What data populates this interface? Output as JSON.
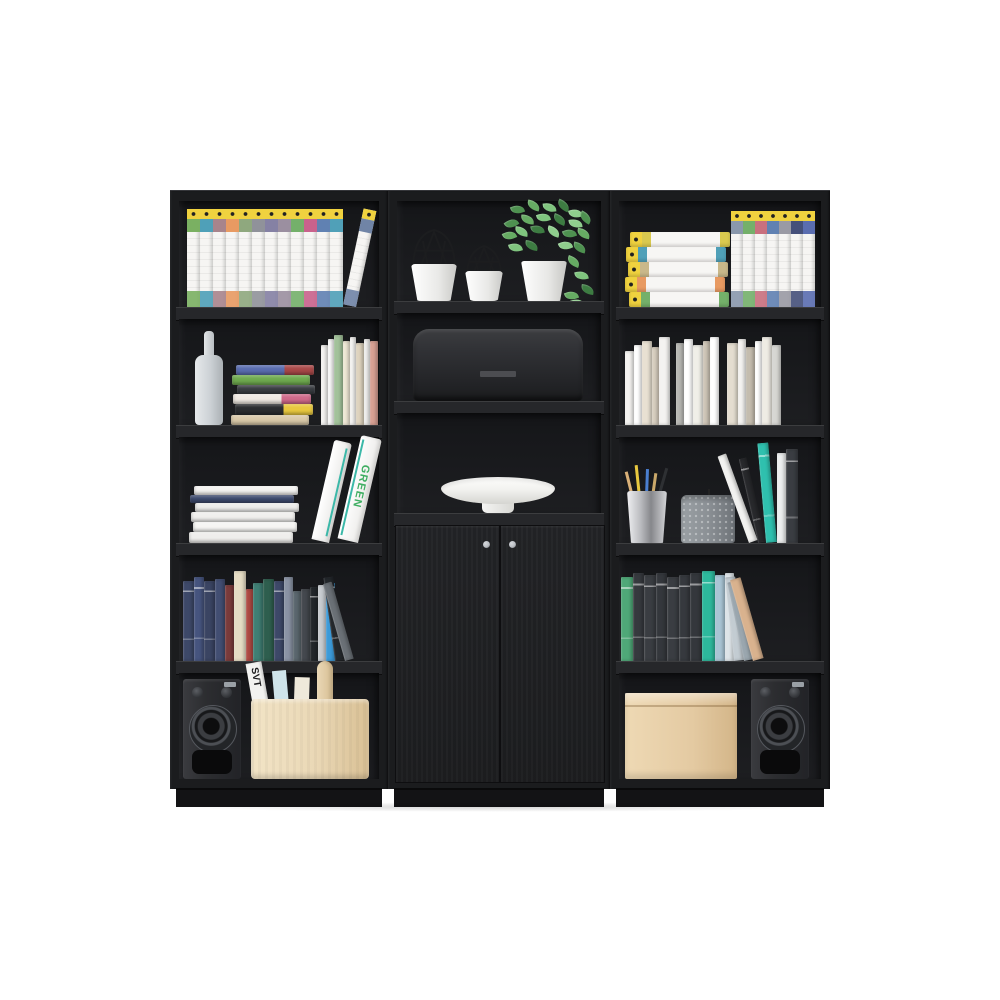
{
  "scene": {
    "background": "#ffffff",
    "frame_color": "#1b1c1e",
    "interior_color": "#18191b",
    "shelf_face_color": "#26272a",
    "plinth_color": "#131315",
    "accent_yellow": "#f0d23f",
    "knob_color": "#b9bdc2",
    "leaf_colors": [
      "#4e9150",
      "#66ab63",
      "#7fc47e",
      "#3d7c42",
      "#8fce8d"
    ]
  },
  "labels": {
    "binder_spine_text": "GREEN",
    "magazine_title": "SVT"
  },
  "units": [
    {
      "id": "left-bookcase",
      "shelves": [
        {
          "items": [
            {
              "type": "ency-row",
              "name": "encyclopedia-books",
              "x": 8,
              "count": 13,
              "vol_w": 13,
              "vol_h": 98,
              "tilt_last": 12,
              "band_colors": [
                "#7ab062",
                "#4fa0b8",
                "#a8848c",
                "#e89a62",
                "#8fa87e",
                "#90929a",
                "#8581a4",
                "#9b8fa0",
                "#74b06a",
                "#c9628c",
                "#6081b2",
                "#50a0b8",
                "#7084a6"
              ]
            }
          ]
        },
        {
          "items": [
            {
              "type": "bottle",
              "name": "vase-bottle",
              "x": 16,
              "w": 28,
              "h": 92,
              "color": "#ccd1d5"
            },
            {
              "type": "hstack",
              "name": "book-stack",
              "x": 52,
              "w": 86,
              "books": [
                {
                  "t": 10,
                  "c": "#d9c9a8"
                },
                {
                  "t": 11,
                  "c": "#2b2d30",
                  "c2": "#e8c83f"
                },
                {
                  "t": 10,
                  "c": "#efe9e2",
                  "c2": "#d06a8a"
                },
                {
                  "t": 9,
                  "c": "#3a3d42"
                },
                {
                  "t": 10,
                  "c": "#6faa4f"
                },
                {
                  "t": 10,
                  "c": "#5a6db0",
                  "c2": "#a84848"
                }
              ]
            },
            {
              "type": "vbooks",
              "name": "books-group",
              "x": 142,
              "books": [
                {
                  "w": 7,
                  "h": 80,
                  "c": "#f4f3f1"
                },
                {
                  "w": 6,
                  "h": 86,
                  "c": "#fbfbfa"
                },
                {
                  "w": 9,
                  "h": 90,
                  "c": "#a2c29a"
                },
                {
                  "w": 7,
                  "h": 84,
                  "c": "#efe8d6"
                },
                {
                  "w": 6,
                  "h": 88,
                  "c": "#f7f6f4"
                },
                {
                  "w": 8,
                  "h": 82,
                  "c": "#ded3be"
                },
                {
                  "w": 6,
                  "h": 86,
                  "c": "#f2f1ef"
                },
                {
                  "w": 8,
                  "h": 84,
                  "c": "#d8a093"
                }
              ]
            }
          ]
        },
        {
          "items": [
            {
              "type": "hstack",
              "name": "white-book-stack",
              "x": 10,
              "w": 112,
              "books": [
                {
                  "t": 11,
                  "c": "#efeeec"
                },
                {
                  "t": 10,
                  "c": "#f6f5f3"
                },
                {
                  "t": 10,
                  "c": "#f0efed"
                },
                {
                  "t": 9,
                  "c": "#ececea"
                },
                {
                  "t": 8,
                  "c": "#3d4a6e"
                },
                {
                  "t": 9,
                  "c": "#f4f3f1"
                }
              ]
            },
            {
              "type": "binders",
              "name": "binders",
              "x": 132,
              "h": 106,
              "text_color": "#3fae62",
              "stripe": "#3bb8a8"
            }
          ]
        },
        {
          "items": [
            {
              "type": "vbooks",
              "name": "books-row",
              "x": 4,
              "books": [
                {
                  "w": 11,
                  "h": 80,
                  "c": "#3d4868",
                  "m": 1
                },
                {
                  "w": 10,
                  "h": 84,
                  "c": "#46547e",
                  "m": 1
                },
                {
                  "w": 11,
                  "h": 80,
                  "c": "#3a4462",
                  "m": 1
                },
                {
                  "w": 10,
                  "h": 82,
                  "c": "#424e72"
                },
                {
                  "w": 9,
                  "h": 76,
                  "c": "#7a3b3b"
                },
                {
                  "w": 12,
                  "h": 90,
                  "c": "#e5dcc4"
                },
                {
                  "w": 7,
                  "h": 72,
                  "c": "#b04a44"
                },
                {
                  "w": 10,
                  "h": 78,
                  "c": "#3f7f74"
                },
                {
                  "w": 11,
                  "h": 82,
                  "c": "#2e5e4e"
                },
                {
                  "w": 10,
                  "h": 80,
                  "c": "#3d4868",
                  "m": 1
                },
                {
                  "w": 9,
                  "h": 84,
                  "c": "#8a93a4"
                },
                {
                  "w": 8,
                  "h": 70,
                  "c": "#5b676e"
                },
                {
                  "w": 9,
                  "h": 72,
                  "c": "#44484e"
                },
                {
                  "w": 8,
                  "h": 74,
                  "c": "#23272b",
                  "m": 1
                },
                {
                  "w": 8,
                  "h": 76,
                  "c": "#c8ccd0"
                },
                {
                  "w": 9,
                  "h": 78,
                  "c": "#3b9ad9"
                },
                {
                  "w": 10,
                  "h": 84,
                  "c": "#23272b",
                  "m": 1,
                  "tilt": -8
                },
                {
                  "w": 9,
                  "h": 80,
                  "c": "#6a7076",
                  "tilt": -16
                }
              ]
            }
          ]
        },
        {
          "items": [
            {
              "type": "speaker",
              "name": "speaker",
              "x": 4,
              "w": 58,
              "h": 100
            },
            {
              "type": "caddy",
              "name": "storage-caddy",
              "x": 72,
              "w": 118,
              "h": 80,
              "color": "#ead8b6"
            }
          ]
        }
      ]
    },
    {
      "id": "center-cabinet",
      "shelves": [
        {
          "items": [
            {
              "type": "wirepot",
              "name": "wire-decor-large",
              "x": 14,
              "w": 46,
              "h": 74
            },
            {
              "type": "wirepot",
              "name": "wire-decor-small",
              "x": 68,
              "w": 38,
              "h": 58
            },
            {
              "type": "plant",
              "name": "potted-plant",
              "x": 106,
              "w": 90
            }
          ]
        },
        {
          "items": [
            {
              "type": "breadbin",
              "name": "bread-bin",
              "x": 16,
              "w": 170,
              "h": 72
            }
          ]
        },
        {
          "items": [
            {
              "type": "bowl",
              "name": "decor-bowl",
              "x": 44,
              "w": 114
            }
          ]
        }
      ],
      "doors": {
        "knob_color": "#b9bdc2"
      }
    },
    {
      "id": "right-bookcase",
      "shelves": [
        {
          "items": [
            {
              "type": "hency",
              "name": "encyclopedia-stack",
              "x": 6,
              "w": 100,
              "t": 15,
              "band_colors": [
                "#74b06a",
                "#e89a62",
                "#c9b88a",
                "#50a0b8",
                "#d9c94f"
              ]
            },
            {
              "type": "ency-row",
              "name": "encyclopedia-books",
              "x": 112,
              "count": 7,
              "vol_w": 12,
              "vol_h": 96,
              "tilt_last": 0,
              "band_colors": [
                "#8a98ac",
                "#74b06a",
                "#c9707e",
                "#6081b2",
                "#9a9aa4",
                "#45507a",
                "#5a6db0"
              ]
            }
          ]
        },
        {
          "items": [
            {
              "type": "vbooks",
              "name": "white-books-row",
              "x": 6,
              "books": [
                {
                  "w": 9,
                  "h": 74,
                  "c": "#f4f3f1"
                },
                {
                  "w": 8,
                  "h": 80,
                  "c": "#ffffff"
                },
                {
                  "w": 10,
                  "h": 84,
                  "c": "#e8e0d2"
                },
                {
                  "w": 7,
                  "h": 78,
                  "c": "#d8cfc0"
                },
                {
                  "w": 11,
                  "h": 88,
                  "c": "#f4f3f1"
                },
                {
                  "w": 8,
                  "h": 82,
                  "c": "#b8b8b4",
                  "gap": 6
                },
                {
                  "w": 9,
                  "h": 86,
                  "c": "#ffffff"
                },
                {
                  "w": 10,
                  "h": 80,
                  "c": "#f0efe8"
                },
                {
                  "w": 7,
                  "h": 84,
                  "c": "#cfc6b8"
                },
                {
                  "w": 9,
                  "h": 88,
                  "c": "#ffffff"
                },
                {
                  "w": 11,
                  "h": 82,
                  "c": "#e4ddd0",
                  "gap": 8
                },
                {
                  "w": 8,
                  "h": 86,
                  "c": "#f4f3f1"
                },
                {
                  "w": 9,
                  "h": 78,
                  "c": "#c4bcae"
                },
                {
                  "w": 7,
                  "h": 84,
                  "c": "#ffffff"
                },
                {
                  "w": 10,
                  "h": 88,
                  "c": "#efece4"
                },
                {
                  "w": 9,
                  "h": 80,
                  "c": "#d7d7d3"
                }
              ]
            }
          ]
        },
        {
          "items": [
            {
              "type": "pencilcup",
              "name": "pencil-cup",
              "x": 8,
              "w": 40,
              "h": 52
            },
            {
              "type": "candle",
              "name": "candle",
              "x": 62,
              "w": 54,
              "h": 48,
              "color": "#8b9095"
            },
            {
              "type": "vbooks",
              "name": "leaning-books",
              "x": 130,
              "books": [
                {
                  "w": 9,
                  "h": 92,
                  "c": "#f2f2f0",
                  "tilt": -20
                },
                {
                  "w": 8,
                  "h": 86,
                  "c": "#28292c",
                  "tilt": -13,
                  "m": 1
                },
                {
                  "w": 11,
                  "h": 100,
                  "c": "#2fc0ae",
                  "tilt": -5,
                  "m": 1
                },
                {
                  "w": 9,
                  "h": 90,
                  "c": "#eceeee"
                },
                {
                  "w": 12,
                  "h": 94,
                  "c": "#3a3d42",
                  "m": 1
                }
              ]
            }
          ]
        },
        {
          "items": [
            {
              "type": "vbooks",
              "name": "books-row",
              "x": 2,
              "books": [
                {
                  "w": 12,
                  "h": 84,
                  "c": "#4fa878",
                  "m": 1
                },
                {
                  "w": 11,
                  "h": 88,
                  "c": "#36393e",
                  "m": 1
                },
                {
                  "w": 12,
                  "h": 86,
                  "c": "#3a3d42",
                  "m": 1
                },
                {
                  "w": 11,
                  "h": 88,
                  "c": "#34373c",
                  "m": 1
                },
                {
                  "w": 12,
                  "h": 84,
                  "c": "#3a3d42",
                  "m": 1
                },
                {
                  "w": 11,
                  "h": 86,
                  "c": "#36393e",
                  "m": 1
                },
                {
                  "w": 12,
                  "h": 88,
                  "c": "#34373c",
                  "m": 1
                },
                {
                  "w": 13,
                  "h": 90,
                  "c": "#2db89c",
                  "m": 1
                },
                {
                  "w": 10,
                  "h": 86,
                  "c": "#a8c4d4"
                },
                {
                  "w": 9,
                  "h": 88,
                  "c": "#dde4e8"
                },
                {
                  "w": 10,
                  "h": 84,
                  "c": "#c3ccd2",
                  "tilt": -6
                },
                {
                  "w": 9,
                  "h": 80,
                  "c": "#9aa6ae",
                  "tilt": -12
                },
                {
                  "w": 11,
                  "h": 84,
                  "c": "#d9b28e",
                  "tilt": -16
                }
              ]
            }
          ]
        },
        {
          "items": [
            {
              "type": "box",
              "name": "storage-box",
              "x": 6,
              "w": 112,
              "h": 86,
              "color": "#e4caa2"
            },
            {
              "type": "speaker",
              "name": "speaker",
              "x": 132,
              "w": 58,
              "h": 100
            }
          ]
        }
      ]
    }
  ]
}
